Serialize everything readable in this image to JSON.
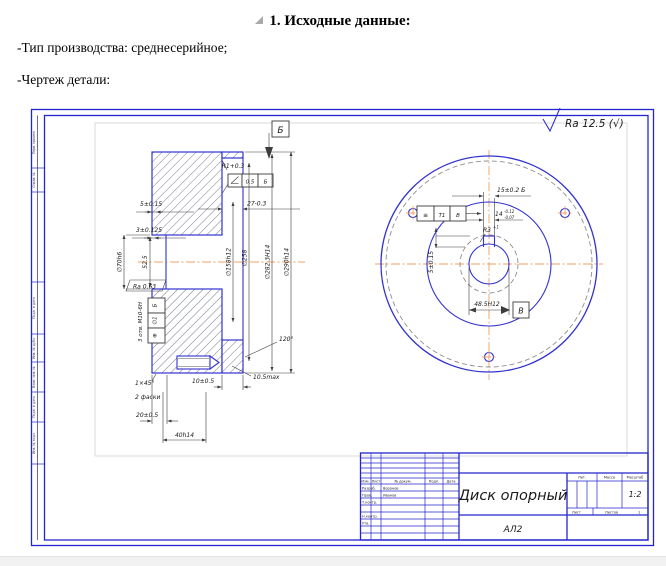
{
  "doc": {
    "heading": "1. Исходные данные:",
    "para_production": "-Тип производства: среднесерийное;",
    "para_drawing": "-Чертеж детали:"
  },
  "colors": {
    "line_blue": "#3232d0",
    "frame_blue": "#2525cc",
    "centerline_orange": "#f0a263"
  },
  "drawing": {
    "roughness": "Ra 12.5 (√)",
    "frame_fields": [
      "Перв. примен.",
      "Справ. №",
      "Подп. и дата",
      "Инв. № дубл.",
      "Взам. инв. №",
      "Подп. и дата",
      "Инв. № подл."
    ],
    "section": {
      "balloon": "Б",
      "r1": "R1+0.3",
      "flatness_value": "0.5",
      "flatness_datum": "Б",
      "dim_27": "27-0.3",
      "dim_5": "5±0.15",
      "dim_3": "3±0.125",
      "dia_70": "∅70h6",
      "dim_52_5": "52.5",
      "ra_hub": "Ra 0.63",
      "position_symbol": "⊕",
      "position_value": "∅1",
      "position_datum": "Б",
      "holes_note": "3 отв. М10-6H",
      "dia_158": "∅158h12",
      "dia_258": "∅258",
      "dia_282": "∅282.3H14",
      "dia_290": "∅290h14",
      "angle_120": "120°",
      "chamfer": "1×45°",
      "chamfer_note": "2 фаски",
      "dim_10": "10±0.5",
      "dim_10_5": "10.5max",
      "dim_20": "20±0.5",
      "dim_40": "40h14"
    },
    "front": {
      "dim_15": "15±0.2 Б",
      "dim_14": "14",
      "dim_14_upper": "-0.12",
      "dim_14_lower": "-0.07",
      "symmetry_symbol": "≡",
      "symmetry_value": "Т1",
      "symmetry_datum": "В",
      "r3": "R3",
      "r3_tol": "+1",
      "dim_5": "5±0.15",
      "dim_48_5": "48.5H12",
      "datum": "В"
    },
    "title_block": {
      "name": "Диск опорный",
      "material": "АЛ2",
      "lit_label": "Лит.",
      "mass_label": "Масса",
      "scale_label": "Масштаб",
      "scale": "1:2",
      "sheet_label": "Лист",
      "sheets_label": "Листов",
      "sheets": "1",
      "cols": [
        "Изм.",
        "Лист",
        "№ докум.",
        "Подп.",
        "Дата"
      ],
      "rows": [
        {
          "role": "Разраб.",
          "name": "Воронов"
        },
        {
          "role": "Пров.",
          "name": "Иванов"
        },
        {
          "role": "Т.контр.",
          "name": ""
        },
        {
          "role": "Н.контр.",
          "name": ""
        },
        {
          "role": "Утв.",
          "name": ""
        }
      ]
    }
  }
}
